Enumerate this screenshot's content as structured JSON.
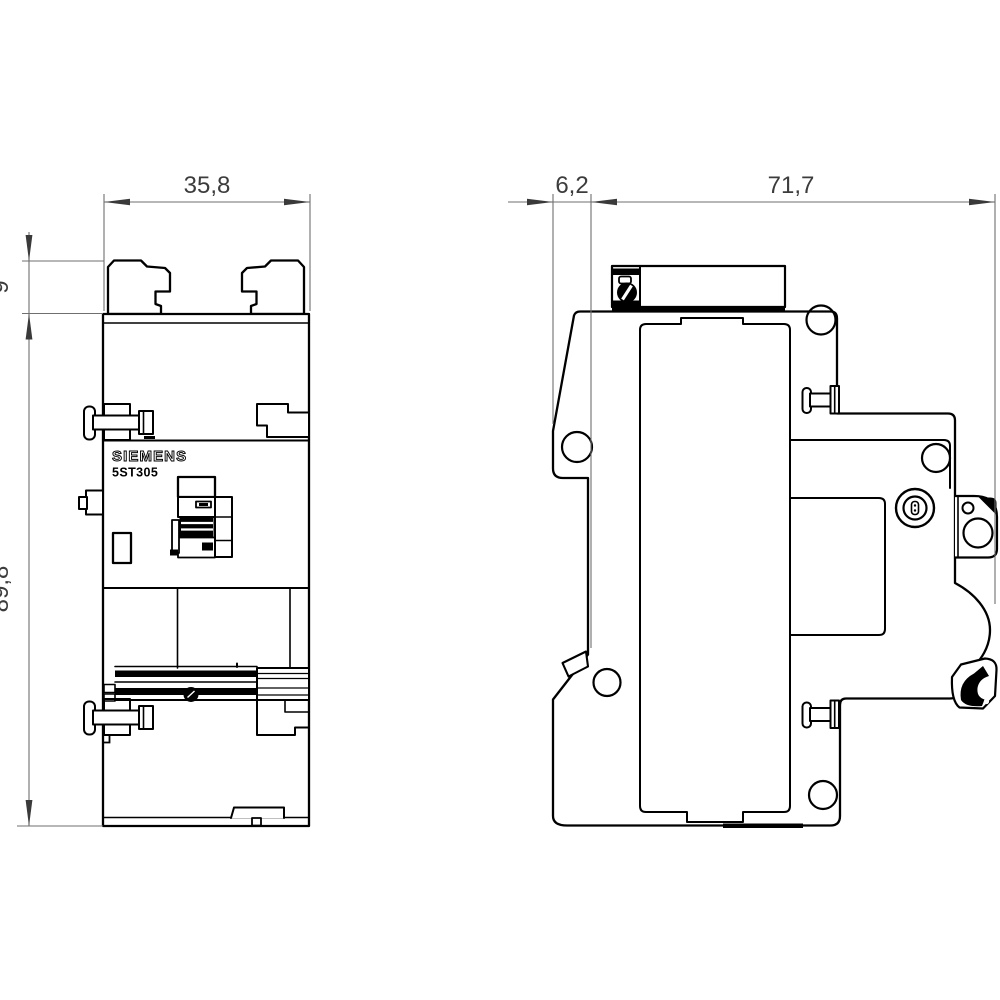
{
  "drawing": {
    "kind": "technical-dimension-drawing",
    "brand_label": "SIEMENS",
    "model_label": "5ST305",
    "dimensions": {
      "front_width": "35,8",
      "terminal_tab_height": "9",
      "body_height": "89,8",
      "front_depth": "6,2",
      "body_depth": "71,7"
    },
    "views": {
      "front": "front-view",
      "side": "side-view"
    },
    "icons": {
      "slotted-screw": "black circle with white slot",
      "terminal-screw": "flanged screw side profile",
      "din-rail-clip": "black spring hook",
      "pozidriv-screw": "concentric circles with insert"
    },
    "colors": {
      "line": "#000000",
      "dimension_line": "#6f6f6f",
      "dimension_text": "#3c3c3c",
      "background": "#ffffff"
    }
  }
}
